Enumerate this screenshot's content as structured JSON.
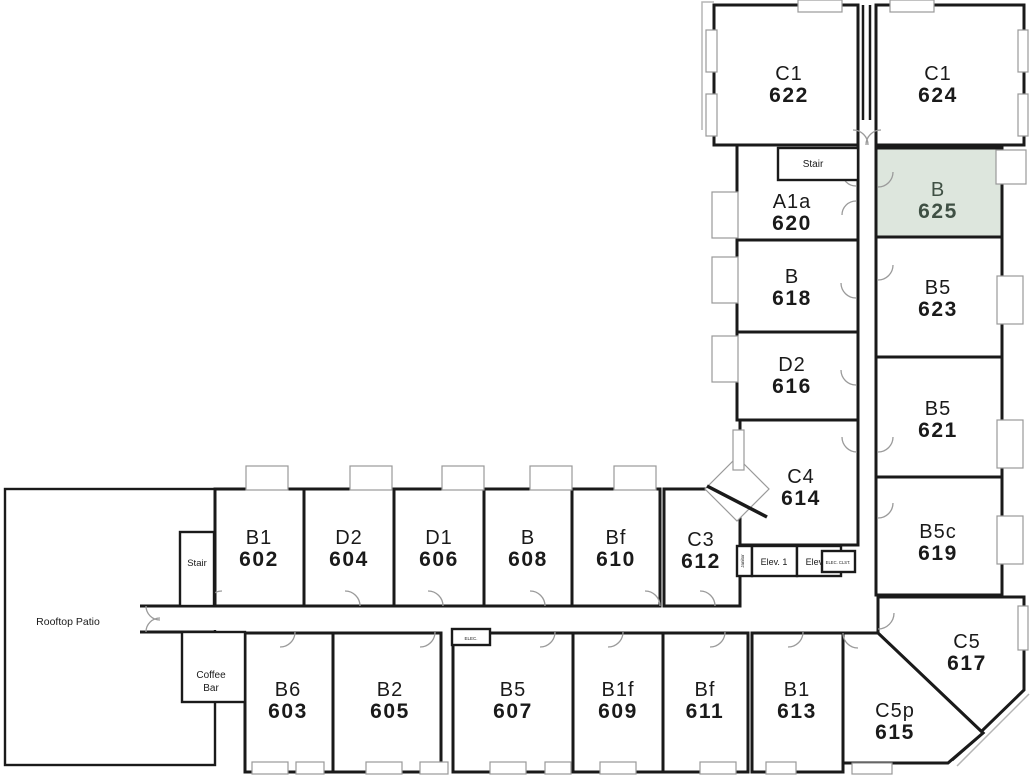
{
  "plan": {
    "width": 1030,
    "height": 775,
    "colors": {
      "wall": "#1a1a1a",
      "window_line": "#999999",
      "door_arc": "#9a9a9a",
      "highlight_fill": "#dde6dd",
      "highlight_text": "#3f5044",
      "text": "#1a1a1a",
      "background": "#ffffff"
    },
    "highlighted_unit": "625",
    "units": [
      {
        "type": "C1",
        "number": "622",
        "rect": [
          714,
          5,
          144,
          140
        ],
        "label": [
          789,
          84
        ],
        "highlighted": false
      },
      {
        "type": "C1",
        "number": "624",
        "rect": [
          876,
          5,
          148,
          140
        ],
        "label": [
          938,
          84
        ],
        "highlighted": false
      },
      {
        "type": "A1a",
        "number": "620",
        "rect": [
          737,
          145,
          121,
          95
        ],
        "label": [
          792,
          212
        ],
        "highlighted": false
      },
      {
        "type": "B",
        "number": "625",
        "rect": [
          876,
          148,
          126,
          89
        ],
        "label": [
          938,
          200
        ],
        "highlighted": true
      },
      {
        "type": "B",
        "number": "618",
        "rect": [
          737,
          240,
          121,
          92
        ],
        "label": [
          792,
          287
        ],
        "highlighted": false
      },
      {
        "type": "B5",
        "number": "623",
        "rect": [
          876,
          237,
          126,
          120
        ],
        "label": [
          938,
          298
        ],
        "highlighted": false
      },
      {
        "type": "D2",
        "number": "616",
        "rect": [
          737,
          332,
          121,
          88
        ],
        "label": [
          792,
          375
        ],
        "highlighted": false
      },
      {
        "type": "B5",
        "number": "621",
        "rect": [
          876,
          357,
          126,
          120
        ],
        "label": [
          938,
          419
        ],
        "highlighted": false
      },
      {
        "type": "C4",
        "number": "614",
        "rect": [
          740,
          420,
          118,
          125
        ],
        "label": [
          801,
          487
        ],
        "highlighted": false
      },
      {
        "type": "B5c",
        "number": "619",
        "rect": [
          876,
          477,
          126,
          118
        ],
        "label": [
          938,
          542
        ],
        "highlighted": false
      },
      {
        "type": "C5",
        "number": "617",
        "points": [
          [
            878,
            597
          ],
          [
            1024,
            597
          ],
          [
            1024,
            690
          ],
          [
            952,
            760
          ],
          [
            983,
            733
          ],
          [
            878,
            633
          ]
        ],
        "label": [
          967,
          652
        ],
        "highlighted": false
      },
      {
        "type": "C5p",
        "number": "615",
        "points": [
          [
            843,
            633
          ],
          [
            878,
            633
          ],
          [
            983,
            733
          ],
          [
            948,
            763
          ],
          [
            843,
            763
          ]
        ],
        "label": [
          895,
          721
        ],
        "highlighted": false
      },
      {
        "type": "B1",
        "number": "602",
        "rect": [
          215,
          489,
          89,
          117
        ],
        "label": [
          259,
          548
        ],
        "highlighted": false
      },
      {
        "type": "D2",
        "number": "604",
        "rect": [
          304,
          489,
          90,
          117
        ],
        "label": [
          349,
          548
        ],
        "highlighted": false
      },
      {
        "type": "D1",
        "number": "606",
        "rect": [
          394,
          489,
          90,
          117
        ],
        "label": [
          439,
          548
        ],
        "highlighted": false
      },
      {
        "type": "B",
        "number": "608",
        "rect": [
          484,
          489,
          88,
          117
        ],
        "label": [
          528,
          548
        ],
        "highlighted": false
      },
      {
        "type": "Bf",
        "number": "610",
        "rect": [
          572,
          489,
          88,
          117
        ],
        "label": [
          616,
          548
        ],
        "highlighted": false
      },
      {
        "type": "C3",
        "number": "612",
        "rect": [
          664,
          489,
          76,
          117
        ],
        "label": [
          701,
          550
        ],
        "highlighted": false
      },
      {
        "type": "B6",
        "number": "603",
        "rect": [
          245,
          633,
          88,
          139
        ],
        "label": [
          288,
          700
        ],
        "highlighted": false
      },
      {
        "type": "B2",
        "number": "605",
        "rect": [
          333,
          633,
          108,
          139
        ],
        "label": [
          390,
          700
        ],
        "highlighted": false
      },
      {
        "type": "B5",
        "number": "607",
        "rect": [
          453,
          633,
          120,
          139
        ],
        "label": [
          513,
          700
        ],
        "highlighted": false
      },
      {
        "type": "B1f",
        "number": "609",
        "rect": [
          573,
          633,
          90,
          139
        ],
        "label": [
          618,
          700
        ],
        "highlighted": false
      },
      {
        "type": "Bf",
        "number": "611",
        "rect": [
          663,
          633,
          85,
          139
        ],
        "label": [
          705,
          700
        ],
        "highlighted": false
      },
      {
        "type": "B1",
        "number": "613",
        "rect": [
          752,
          633,
          91,
          139
        ],
        "label": [
          797,
          700
        ],
        "highlighted": false
      }
    ],
    "areas": [
      {
        "id": "rooftop-patio",
        "lines": [
          "Rooftop Patio"
        ],
        "rect": [
          5,
          489,
          210,
          276
        ],
        "label_pos": [
          68,
          625
        ],
        "font": 10.5,
        "stroke": 3
      },
      {
        "id": "stair-top",
        "lines": [
          "Stair"
        ],
        "rect": [
          778,
          148,
          80,
          32
        ],
        "label_pos": [
          813,
          167
        ],
        "font": 10,
        "stroke": 2.4
      },
      {
        "id": "stair-bottom",
        "lines": [
          "Stair"
        ],
        "rect": [
          180,
          532,
          34,
          74
        ],
        "label_pos": [
          197,
          566
        ],
        "font": 9.5,
        "stroke": 2.4
      },
      {
        "id": "janitor",
        "lines": [
          "Janitor"
        ],
        "rect": [
          737,
          546,
          15,
          30
        ],
        "label_pos": [
          744,
          561
        ],
        "font": 4.5,
        "stroke": 2,
        "rotate": true
      },
      {
        "id": "elev-1",
        "lines": [
          "Elev. 1"
        ],
        "rect": [
          752,
          546,
          45,
          30
        ],
        "label_pos": [
          774,
          565
        ],
        "font": 9,
        "stroke": 2.4
      },
      {
        "id": "elev-2",
        "lines": [
          "Elev. 2"
        ],
        "rect": [
          797,
          546,
          44,
          30
        ],
        "label_pos": [
          819,
          565
        ],
        "font": 9,
        "stroke": 2.4
      },
      {
        "id": "elec-clst",
        "lines": [
          "ELEC. CLST."
        ],
        "rect": [
          822,
          551,
          33,
          21
        ],
        "label_pos": [
          838,
          564
        ],
        "font": 4.2,
        "stroke": 2
      },
      {
        "id": "bath",
        "lines": [
          "Bath"
        ],
        "rect": [
          220,
          637,
          25,
          26
        ],
        "label_pos": [
          232,
          653
        ],
        "font": 6,
        "stroke": 2
      },
      {
        "id": "coffee-bar",
        "lines": [
          "Coffee",
          "Bar"
        ],
        "rect": [
          182,
          632,
          63,
          70
        ],
        "label_pos": [
          211,
          678
        ],
        "font": 10,
        "stroke": 2.4
      },
      {
        "id": "elec",
        "lines": [
          "ELEC."
        ],
        "rect": [
          452,
          629,
          38,
          16
        ],
        "label_pos": [
          471,
          640
        ],
        "font": 4.5,
        "stroke": 2
      }
    ],
    "windows": [
      [
        798,
        0,
        44,
        12
      ],
      [
        890,
        0,
        44,
        12
      ],
      [
        706,
        30,
        11,
        42
      ],
      [
        706,
        94,
        11,
        42
      ],
      [
        712,
        192,
        26,
        46
      ],
      [
        712,
        257,
        26,
        46
      ],
      [
        712,
        336,
        26,
        46
      ],
      [
        733,
        430,
        11,
        40
      ],
      [
        1018,
        30,
        10,
        42
      ],
      [
        1018,
        94,
        10,
        42
      ],
      [
        996,
        150,
        30,
        34
      ],
      [
        997,
        276,
        26,
        48
      ],
      [
        997,
        420,
        26,
        48
      ],
      [
        997,
        516,
        26,
        48
      ],
      [
        1018,
        606,
        10,
        44
      ],
      [
        246,
        466,
        42,
        24
      ],
      [
        350,
        466,
        42,
        24
      ],
      [
        442,
        466,
        42,
        24
      ],
      [
        530,
        466,
        42,
        24
      ],
      [
        614,
        466,
        42,
        24
      ],
      [
        252,
        762,
        36,
        12
      ],
      [
        296,
        762,
        28,
        12
      ],
      [
        366,
        762,
        36,
        12
      ],
      [
        420,
        762,
        28,
        12
      ],
      [
        490,
        762,
        36,
        12
      ],
      [
        545,
        762,
        26,
        12
      ],
      [
        600,
        762,
        36,
        12
      ],
      [
        700,
        762,
        36,
        12
      ],
      [
        766,
        762,
        30,
        12
      ],
      [
        852,
        763,
        40,
        11
      ]
    ],
    "doors": [
      [
        853,
        145,
        15,
        "ne"
      ],
      [
        881,
        145,
        15,
        "nw"
      ],
      [
        856,
        172,
        14,
        "sw"
      ],
      [
        856,
        215,
        14,
        "nw"
      ],
      [
        856,
        283,
        15,
        "sw"
      ],
      [
        856,
        370,
        15,
        "sw"
      ],
      [
        857,
        437,
        15,
        "sw"
      ],
      [
        878,
        172,
        15,
        "se"
      ],
      [
        878,
        265,
        15,
        "se"
      ],
      [
        878,
        437,
        15,
        "se"
      ],
      [
        878,
        503,
        15,
        "se"
      ],
      [
        878,
        613,
        16,
        "se"
      ],
      [
        858,
        633,
        15,
        "sw"
      ],
      [
        222,
        606,
        15,
        "nw"
      ],
      [
        345,
        606,
        15,
        "ne"
      ],
      [
        428,
        606,
        15,
        "ne"
      ],
      [
        530,
        606,
        15,
        "ne"
      ],
      [
        645,
        606,
        15,
        "ne"
      ],
      [
        700,
        606,
        15,
        "ne"
      ],
      [
        160,
        606,
        14,
        "sw"
      ],
      [
        160,
        632,
        14,
        "nw"
      ],
      [
        222,
        632,
        13,
        "se"
      ],
      [
        280,
        632,
        15,
        "se"
      ],
      [
        420,
        632,
        15,
        "se"
      ],
      [
        540,
        632,
        15,
        "se"
      ],
      [
        608,
        632,
        15,
        "se"
      ],
      [
        710,
        632,
        15,
        "se"
      ],
      [
        788,
        632,
        15,
        "se"
      ]
    ],
    "decor": {
      "corridor_stub_rect": [
        138,
        604,
        80,
        26
      ],
      "bay_window_diamond": [
        [
          737,
          457
        ],
        [
          769,
          489
        ],
        [
          737,
          521
        ],
        [
          705,
          489
        ]
      ],
      "walls": [
        {
          "pts": [
            [
              863,
              5
            ],
            [
              863,
              120
            ]
          ],
          "w": 2.5
        },
        {
          "pts": [
            [
              870,
              5
            ],
            [
              870,
              120
            ]
          ],
          "w": 2.5
        },
        {
          "pts": [
            [
              740,
              545
            ],
            [
              740,
              606
            ]
          ],
          "w": 3
        },
        {
          "pts": [
            [
              140,
              606
            ],
            [
              215,
              606
            ]
          ],
          "w": 3
        },
        {
          "pts": [
            [
              140,
              632
            ],
            [
              215,
              632
            ]
          ],
          "w": 3
        },
        {
          "pts": [
            [
              707,
              486
            ],
            [
              767,
              517
            ]
          ],
          "w": 3.5
        }
      ],
      "gray_lines": [
        {
          "pts": [
            [
              702,
              130
            ],
            [
              702,
              2
            ],
            [
              714,
              2
            ]
          ],
          "w": 1.5
        },
        {
          "pts": [
            [
              1029,
              694
            ],
            [
              957,
              766
            ]
          ],
          "w": 1.5
        }
      ]
    }
  }
}
